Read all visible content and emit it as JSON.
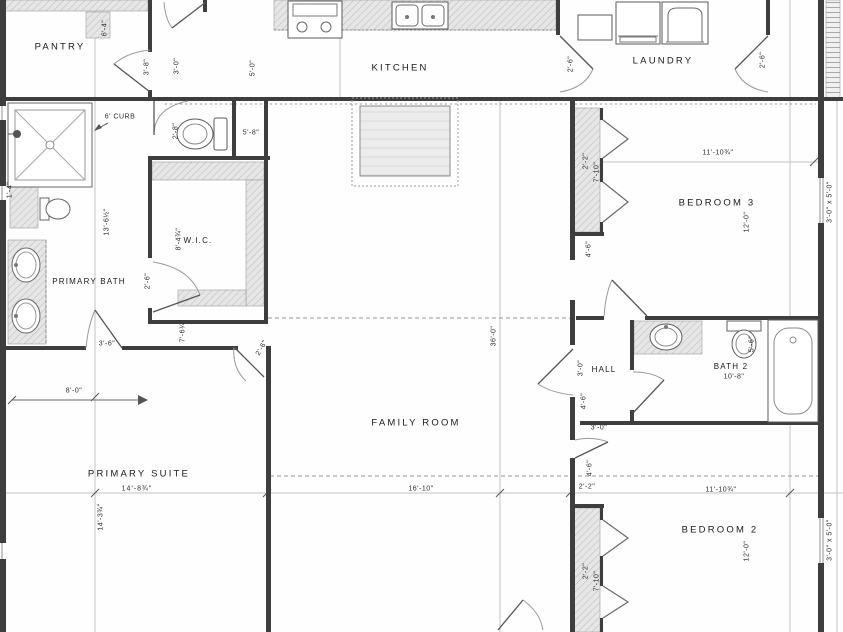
{
  "drawing_type": "residential floor plan",
  "labels": {
    "pantry": "PANTRY",
    "kitchen": "KITCHEN",
    "laundry": "LAUNDRY",
    "primary_bath": "PRIMARY BATH",
    "wic": "W.I.C.",
    "family_room": "FAMILY ROOM",
    "primary_suite": "PRIMARY SUITE",
    "primary_suite_size": "14'-8¾\"",
    "bedroom3": "BEDROOM 3",
    "bedroom3_width": "11'-10¾\"",
    "bedroom3_depth": "12'-0\"",
    "hall": "HALL",
    "bath2": "BATH 2",
    "bath2_size": "10'-8\"",
    "bedroom2": "BEDROOM 2",
    "bedroom2_width": "11'-10¾\"",
    "bedroom2_depth": "12'-0\""
  },
  "dims": {
    "pantry_w": "6'-4\"",
    "door_a": "3'-8\"",
    "door_b": "3'-0\"",
    "door_c": "5'-0\"",
    "laundry_door_l": "2'-6\"",
    "laundry_door_r": "2'-6\"",
    "curb": "6' CURB",
    "wc": "2'-8\"",
    "linen": "5'-8\"",
    "wall_l": "1'-4\"",
    "bath_len": "13'-6½\"",
    "wic_w": "8'-4¾\"",
    "wic_door": "2'-6\"",
    "bath_door": "3'-6\"",
    "wic_len": "7'-6¼\"",
    "suite_door": "2'-6\"",
    "suite_offset": "8'-0\"",
    "suite_len": "14'-3¾\"",
    "overall_depth": "36'-0\"",
    "family_w": "16'-10\"",
    "b3_closet_d": "2'-2\"",
    "b3_closet_w": "7'-10\"",
    "b3_wall": "4'-6\"",
    "window_b3": "3'-0\" x 5'-0\"",
    "hall_a": "3'-0\"",
    "hall_b": "4'-6\"",
    "hall_door": "3'-0\"",
    "bath2_a": "5'-6\"",
    "b2_wall": "4'-6\"",
    "b2_jog": "2'-2\"",
    "b2_closet_d": "2'-2\"",
    "b2_closet_w": "7'-10\"",
    "window_b2": "3'-0\" x 5'-0\""
  }
}
